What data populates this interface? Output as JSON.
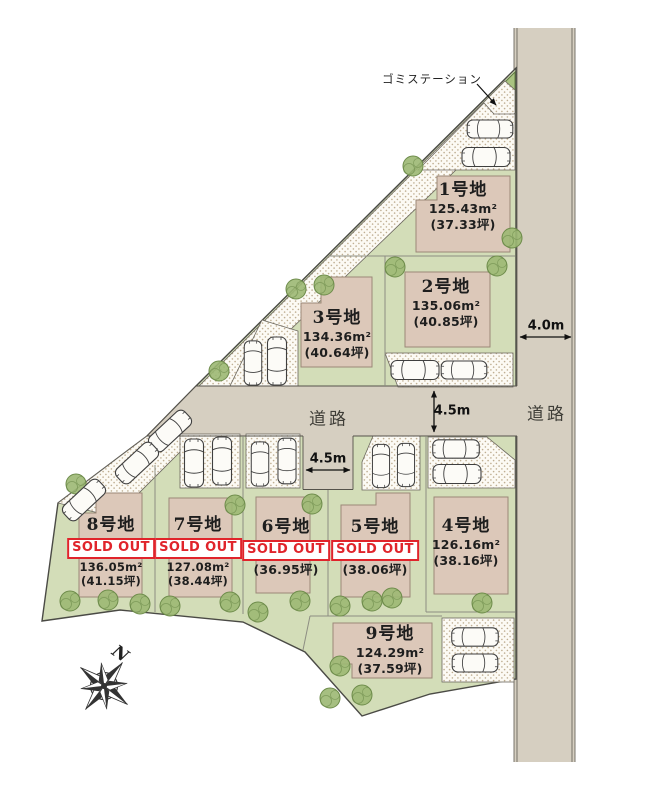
{
  "labels": {
    "garbage_station": "ゴミステーション",
    "road": "道路",
    "sold_out": "SOLD OUT",
    "north": "N"
  },
  "dimensions": {
    "right_road_width": "4.0m",
    "main_road_width": "4.5m",
    "stub_road_width": "4.5m"
  },
  "lots": [
    {
      "name": "1号地",
      "area_m2": "125.43m²",
      "area_tsubo": "(37.33坪)",
      "sold": false
    },
    {
      "name": "2号地",
      "area_m2": "135.06m²",
      "area_tsubo": "(40.85坪)",
      "sold": false
    },
    {
      "name": "3号地",
      "area_m2": "134.36m²",
      "area_tsubo": "(40.64坪)",
      "sold": false
    },
    {
      "name": "4号地",
      "area_m2": "126.16m²",
      "area_tsubo": "(38.16坪)",
      "sold": false
    },
    {
      "name": "5号地",
      "area_m2": "",
      "area_tsubo": "(38.06坪)",
      "sold": true
    },
    {
      "name": "6号地",
      "area_m2": "",
      "area_tsubo": "(36.95坪)",
      "sold": true
    },
    {
      "name": "7号地",
      "area_m2": "127.08m²",
      "area_tsubo": "(38.44坪)",
      "sold": true
    },
    {
      "name": "8号地",
      "area_m2": "136.05m²",
      "area_tsubo": "(41.15坪)",
      "sold": true
    },
    {
      "name": "9号地",
      "area_m2": "124.29m²",
      "area_tsubo": "(37.59坪)",
      "sold": false
    }
  ],
  "colors": {
    "site_green": "#d3ddb8",
    "road_gray": "#d6cfc1",
    "house_beige": "#dcc8b9",
    "sold_red": "#e0242b",
    "tree_green": "#9cb873"
  }
}
